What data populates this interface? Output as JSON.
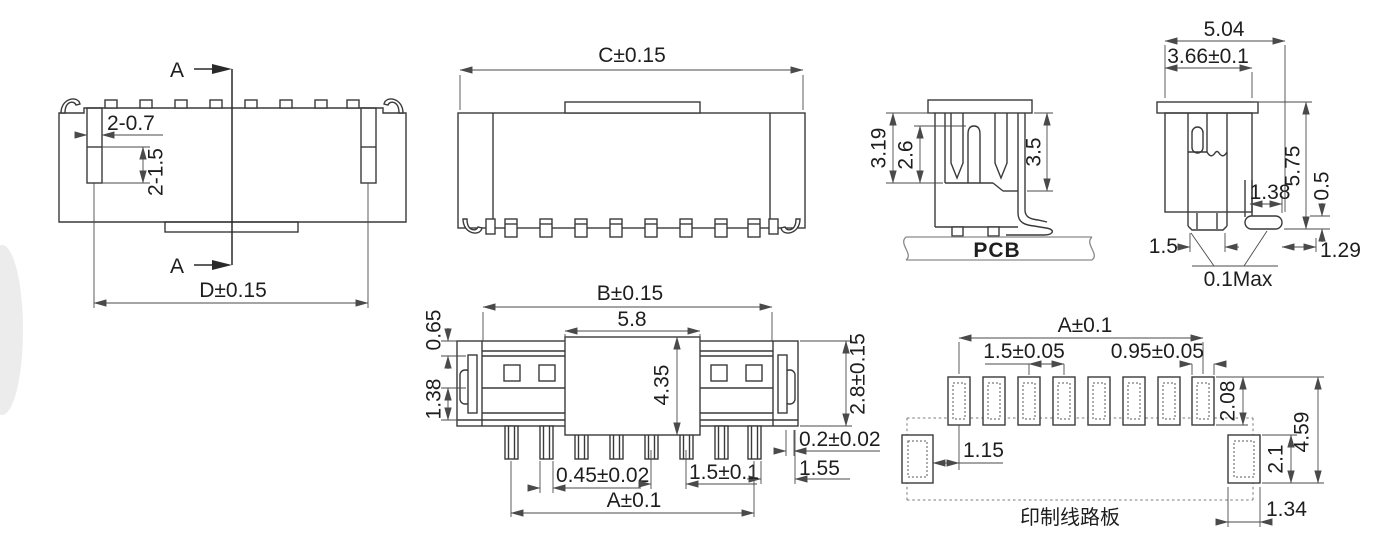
{
  "colors": {
    "background": "#ffffff",
    "line": "#3a3a3a",
    "dim_line": "#4a4a4a",
    "text": "#1e1e1e",
    "pcb_gray": "#8a8a8a"
  },
  "back_view": {
    "section_label_top": "A",
    "section_label_bottom": "A",
    "slot_width": "2-0.7",
    "slot_depth": "2-1.5",
    "mount_span": "D±0.15"
  },
  "front_view": {
    "overall_length": "C±0.15"
  },
  "section_view": {
    "housing_height": "3.19",
    "contact_height": "2.6",
    "cavity_depth": "3.5",
    "board_label": "PCB"
  },
  "side_view": {
    "overall_depth": "5.04",
    "housing_depth": "3.66±0.1",
    "overall_height": "5.75",
    "lead_thickness": "0.5",
    "lead_length": "1.38",
    "pin_width": "1.5",
    "tip_clearance": "1.29",
    "coplanarity": "0.1Max"
  },
  "top_view": {
    "body_length": "B±0.15",
    "tab_width": "5.8",
    "wall_thickness": "0.65",
    "groove_width": "1.38",
    "tab_depth": "4.35",
    "body_width": "2.8±0.15",
    "plating_thickness": "0.2±0.02",
    "end_clearance": "1.55",
    "pin_thickness": "0.45±0.02",
    "pin_pitch": "1.5±0.1",
    "pin_span": "A±0.1"
  },
  "pcb_pattern": {
    "pad_span": "A±0.1",
    "pad_pitch": "1.5±0.05",
    "pad_width": "0.95±0.05",
    "pad_height": "2.08",
    "pattern_height": "4.59",
    "corner_pad_gap": "1.15",
    "corner_pad_height": "2.1",
    "corner_pad_width": "1.34",
    "board_caption": "印制线路板"
  }
}
